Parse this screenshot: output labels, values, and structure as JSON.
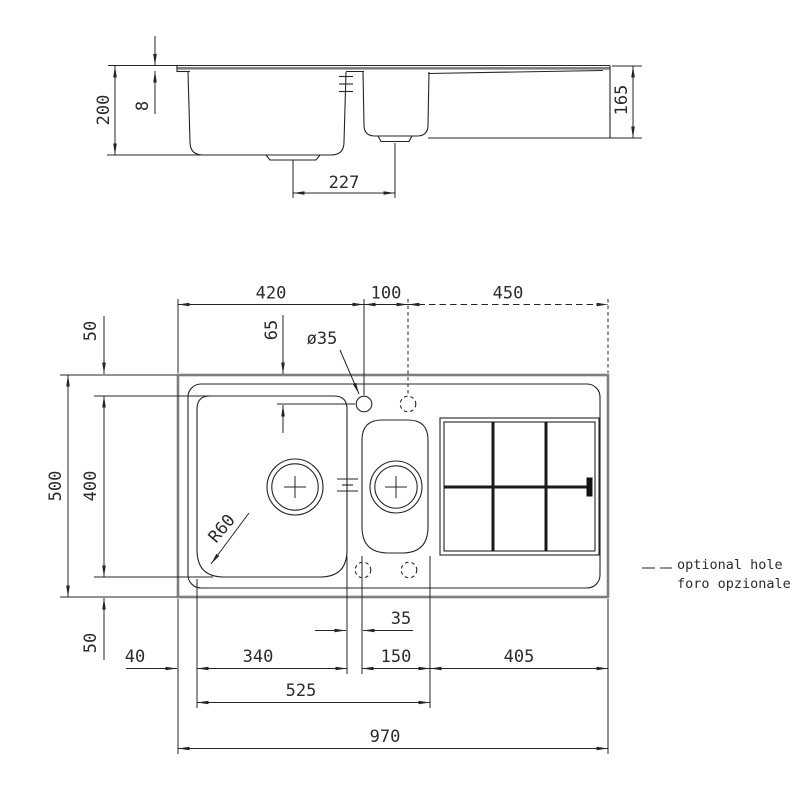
{
  "section": {
    "depth_left": "200",
    "rim_thickness": "8",
    "depth_right": "165",
    "drain_distance": "227"
  },
  "plan": {
    "top": {
      "d420": "420",
      "d100": "100",
      "d450": "450"
    },
    "left": {
      "d50_top": "50",
      "d400": "400",
      "d500": "500",
      "d50_bottom": "50"
    },
    "holes": {
      "diameter_label": "ø35",
      "offset_label": "65"
    },
    "corner_radius_label": "R60",
    "bottom": {
      "d35": "35",
      "d40": "40",
      "d340": "340",
      "d150": "150",
      "d405": "405",
      "d525": "525",
      "d970": "970"
    }
  },
  "legend": {
    "line1": "optional hole",
    "line2": "foro opzionale"
  },
  "colors": {
    "ink": "#242424",
    "outline_gray": "#7f7f7f"
  }
}
